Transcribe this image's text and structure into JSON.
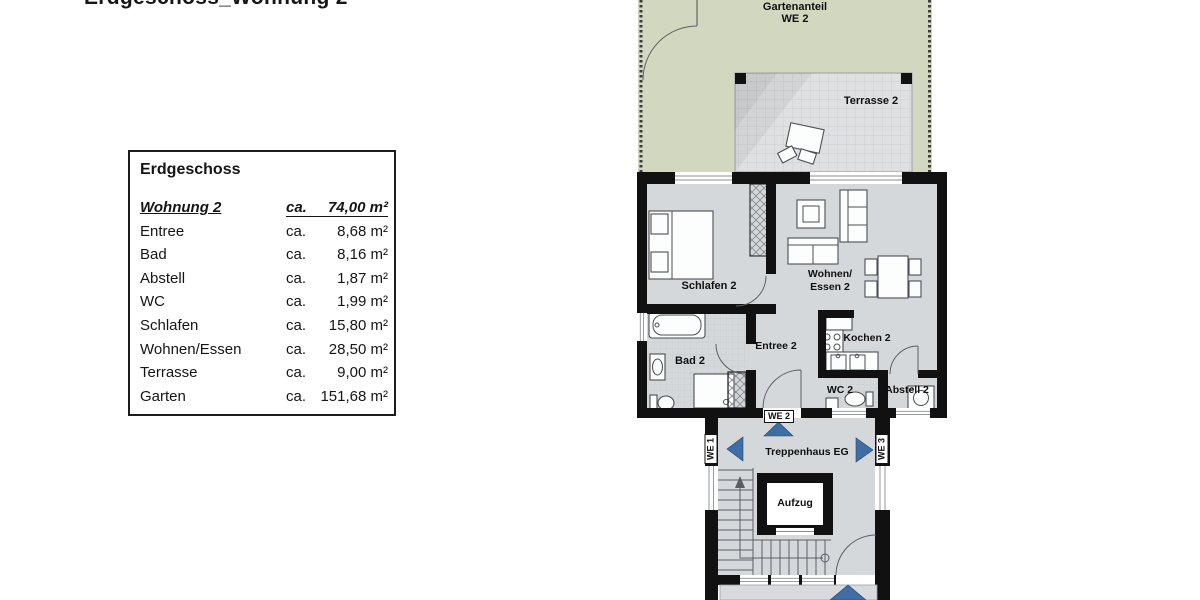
{
  "title": "Erdgeschoss_Wohnung 2",
  "legend": {
    "heading": "Erdgeschoss",
    "header": {
      "name": "Wohnung 2",
      "ca": "ca.",
      "value": "74,00 m²"
    },
    "rows": [
      {
        "name": "Entree",
        "ca": "ca.",
        "value": "8,68 m²"
      },
      {
        "name": "Bad",
        "ca": "ca.",
        "value": "8,16 m²"
      },
      {
        "name": "Abstell",
        "ca": "ca.",
        "value": "1,87 m²"
      },
      {
        "name": "WC",
        "ca": "ca.",
        "value": "1,99 m²"
      },
      {
        "name": "Schlafen",
        "ca": "ca.",
        "value": "15,80 m²"
      },
      {
        "name": "Wohnen/Essen",
        "ca": "ca.",
        "value": "28,50 m²"
      },
      {
        "name": "Terrasse",
        "ca": "ca.",
        "value": "9,00 m²"
      },
      {
        "name": "Garten",
        "ca": "ca.",
        "value": "151,68 m²"
      }
    ]
  },
  "plan": {
    "garden": {
      "label_line1": "Gartenanteil",
      "label_line2": "WE 2"
    },
    "terrace": {
      "label": "Terrasse 2"
    },
    "rooms": {
      "schlafen": "Schlafen 2",
      "wohnen_line1": "Wohnen/",
      "wohnen_line2": "Essen 2",
      "entree": "Entree 2",
      "bad": "Bad 2",
      "kochen": "Kochen 2",
      "wc": "WC 2",
      "abstell": "Abstell 2",
      "treppenhaus": "Treppenhaus EG",
      "aufzug": "Aufzug"
    },
    "door_tags": {
      "we1": "WE 1",
      "we2": "WE 2",
      "we3": "WE 3"
    }
  },
  "colors": {
    "garden_green": "#d2d8c0",
    "floor_gray": "#d5d8db",
    "terrace_gray": "#dee0e2",
    "wall_black": "#111111",
    "arrow_blue": "#3f6da6"
  }
}
